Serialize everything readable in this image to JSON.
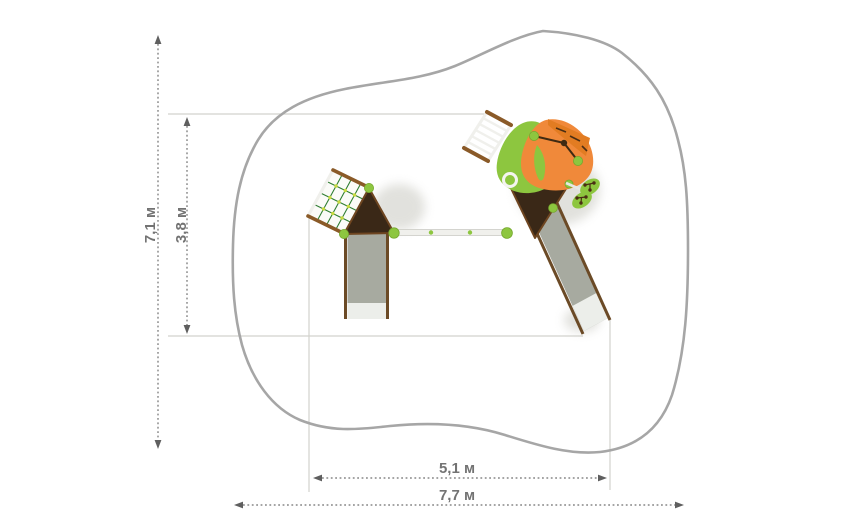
{
  "dimension_labels": {
    "safety_zone_height": "7,1 м",
    "equipment_height": "3,8 м",
    "equipment_width": "5,1 м",
    "safety_zone_width": "7,7 м"
  },
  "colors": {
    "background": "#ffffff",
    "safety_zone_outline": "#a6a6a6",
    "dimension_gray": "#6f6f6f",
    "extension_gray": "#d2d2cd",
    "roof_orange": "#f0893a",
    "roof_orange_dark": "#e27c22",
    "accent_green": "#8dc63f",
    "net_green": "#2f7d32",
    "net_dot_yellow": "#c6d93f",
    "wood_brown": "#8a5a28",
    "platform_brown": "#3a2817",
    "slide_gray": "#a7aaa0",
    "plastic_white": "#f0f0ec",
    "shadow": "#bdbdb4"
  }
}
